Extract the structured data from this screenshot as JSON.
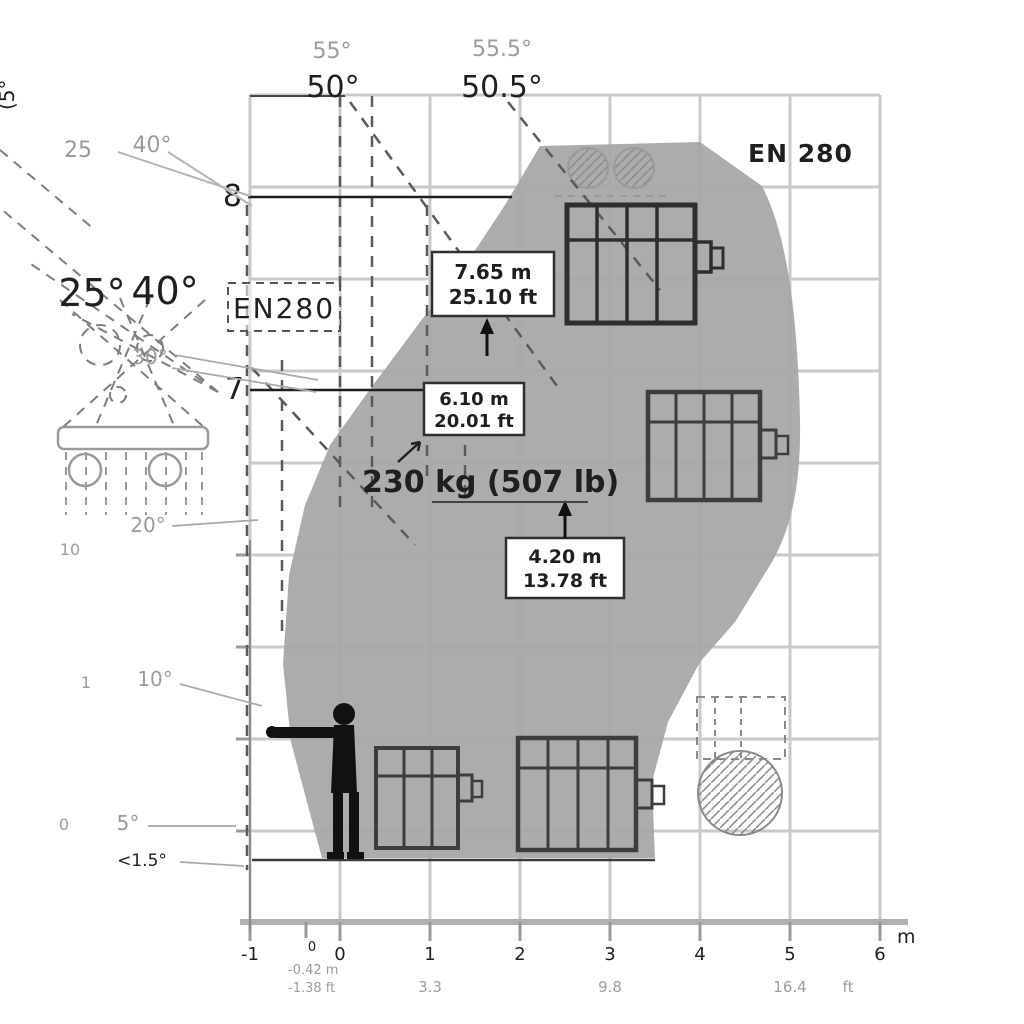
{
  "badges": {
    "grid_standard": "EN 280",
    "envelope_standard": "EN280"
  },
  "angles": {
    "vertical_top_left": "(5°",
    "top_pair_left_gray": "55°",
    "top_pair_left_black": "50°",
    "top_pair_right_gray": "55.5°",
    "top_pair_right_black": "50.5°",
    "gray_row_left": "25",
    "gray_row_right": "40°",
    "black_row_left": "25°",
    "black_row_right": "40°",
    "side_30": "30°",
    "side_20": "20°",
    "side_10": "10°",
    "side_5": "5°",
    "side_1_5": "<1.5°",
    "side_small_10": "10",
    "side_small_1": "1",
    "side_small_0": "0"
  },
  "height_markers": {
    "h8": "8",
    "h7": "7"
  },
  "dim_boxes": [
    {
      "m": "7.65 m",
      "ft": "25.10 ft"
    },
    {
      "m": "6.10 m",
      "ft": "20.01 ft"
    },
    {
      "m": "4.20 m",
      "ft": "13.78 ft"
    }
  ],
  "capacity": "230 kg (507 lb)",
  "x_axis": {
    "tick_labels": [
      "-1",
      "0",
      "1",
      "2",
      "3",
      "4",
      "5",
      "6"
    ],
    "unit": "m",
    "ft_tick_1": "3.3",
    "ft_tick_2": "9.8",
    "ft_tick_3": "16.4",
    "ft_unit": "ft",
    "origin_zero": "0",
    "origin_note_m": "-0.42 m",
    "origin_note_ft": "-1.38 ft"
  },
  "colors": {
    "envelope": "#a8a8a8",
    "grid": "#c9c9c9",
    "axis": "#b0b0b0",
    "ink": "#1f1f1f",
    "muted": "#9b9b9b",
    "basket": "#3d3d3d"
  }
}
